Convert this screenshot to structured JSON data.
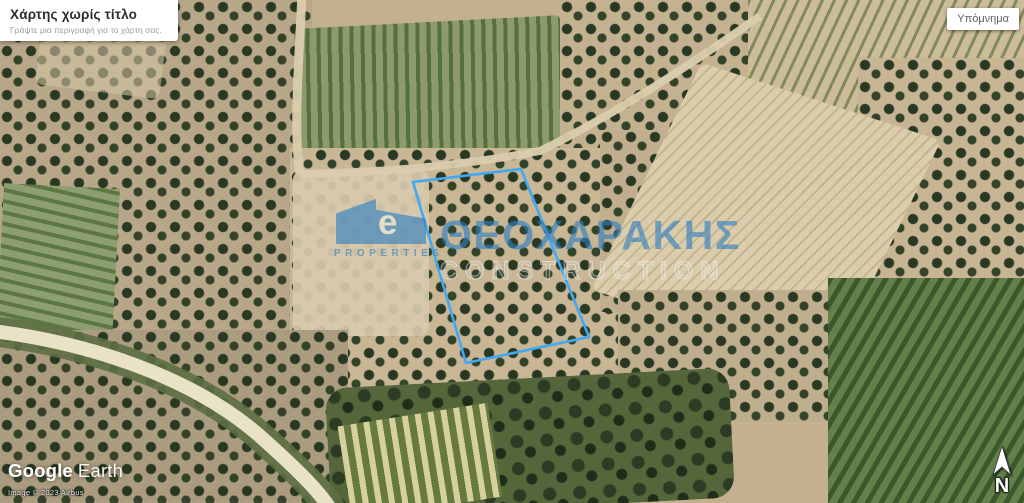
{
  "title_card": {
    "title": "Χάρτης χωρίς τίτλο",
    "subtitle": "Γράψτε μια περιγραφή για το χάρτη σας."
  },
  "legend_button": {
    "label": "Υπόμνημα"
  },
  "watermark": {
    "brand": "ΘΕΟΧΑΡΑΚΗΣ",
    "line2": "CONSTRUCTION",
    "logo_letter": "e",
    "logo_caption": "PROPERTIES"
  },
  "parcel": {
    "points": "413,182 521,169 589,337 466,363"
  },
  "attribution": {
    "logo_google": "Google",
    "logo_earth": "Earth",
    "imagery": "Image © 2023 Airbus"
  },
  "compass": {
    "north_label": "N"
  },
  "colors": {
    "parcel_stroke": "#3fa9f5",
    "watermark_blue": "#2e7fc2"
  }
}
